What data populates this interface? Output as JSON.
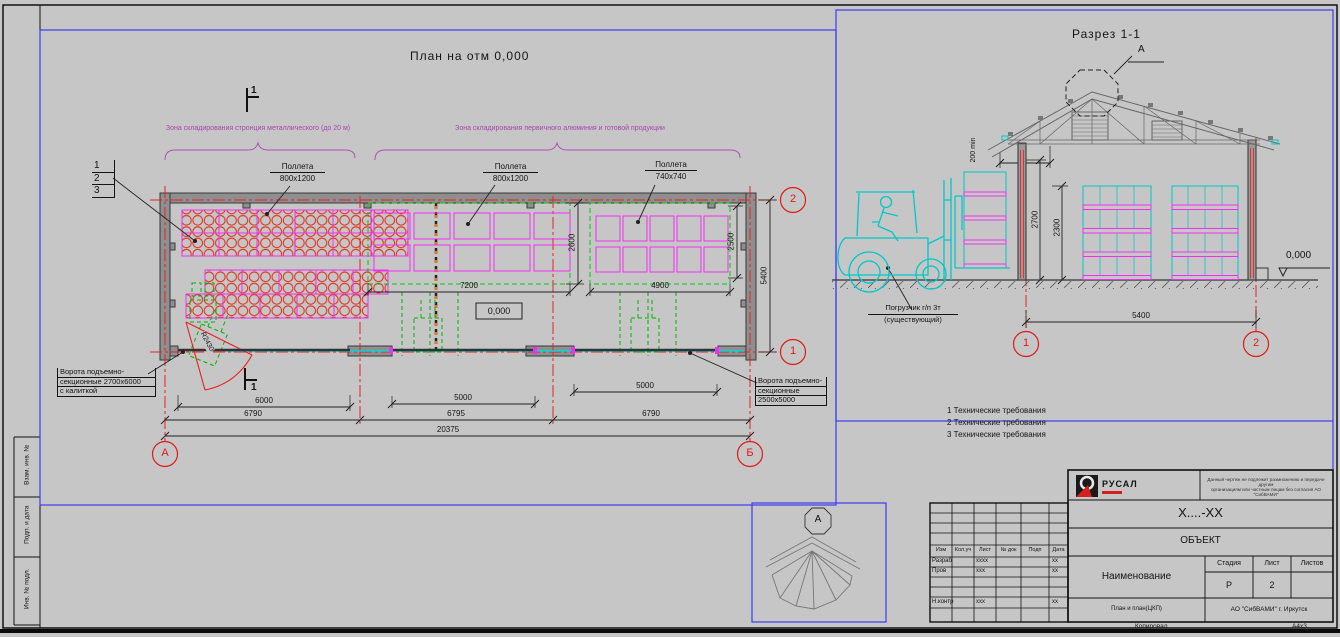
{
  "titles": {
    "plan": "План на отм 0,000",
    "section": "Разрез 1-1"
  },
  "zones": {
    "left": "Зона складирования стронция металлического (до 20 м)",
    "right": "Зона складирования первичного алюминия и готовой продукции"
  },
  "pallets": [
    {
      "l1": "Поллета",
      "l2": "800x1200"
    },
    {
      "l1": "Поллета",
      "l2": "800x1200"
    },
    {
      "l1": "Поллета",
      "l2": "740x740"
    }
  ],
  "stack_ref": [
    "1",
    "2",
    "3"
  ],
  "gate_left": {
    "l1": "Ворота подъемно-",
    "l2": "секционные 2700x6000",
    "l3": "с калиткой"
  },
  "gate_right": {
    "l1": "Ворота подъемно-",
    "l2": "секционные",
    "l3": "2500x5000"
  },
  "radius_label": "R2430",
  "dims": {
    "d7200": "7200",
    "d4900": "4900",
    "d2600": "2600",
    "d2500": "2500",
    "d5400": "5400",
    "d6000": "6000",
    "d5000a": "5000",
    "d5000b": "5000",
    "d6790a": "6790",
    "d6795": "6795",
    "d6790b": "6790",
    "d20375": "20375"
  },
  "elev_plan": "0,000",
  "markers": {
    "a": "А",
    "b": "Б",
    "m1": "1",
    "m2": "2"
  },
  "cuts": {
    "top": "1",
    "bottom": "1"
  },
  "section": {
    "dim200a": "200",
    "dim200b": "min",
    "d2700": "2700",
    "d2300": "2300",
    "d5400": "5400",
    "elev": "0,000",
    "m1": "1",
    "m2": "2",
    "fork1": "Погрузчик г/п 3т",
    "fork2": "(существующий)",
    "detail_ref": "А"
  },
  "detail": {
    "badge": "А"
  },
  "tech": [
    "1  Технические требования",
    "2  Технические требования",
    "3  Технические требования"
  ],
  "rev": {
    "headers": [
      "Изм",
      "Кол.уч",
      "Лист",
      "№ док",
      "Подп",
      "Дата"
    ],
    "rows": [
      [
        "Разраб",
        "xxxx",
        "xx"
      ],
      [
        "Пров",
        "xxx",
        "xx"
      ],
      [
        "Н.контр",
        "xxx",
        "xx"
      ]
    ]
  },
  "tb": {
    "logo": "РУСАЛ",
    "disclaimer1": "Данный чертеж не подлежит размножению и передаче другим",
    "disclaimer2": "организациям или частным лицам без согласия АО \"СибВАМИ\"",
    "code": "Х....-ХХ",
    "object": "ОБЪЕКТ",
    "name": "Наименование",
    "stage_h": "Стадия",
    "sheet_h": "Лист",
    "sheets_h": "Листов",
    "stage_v": "Р",
    "sheet_v": "2",
    "bottom_left": "План и план(ЦКП)",
    "company": "АО \"СибВАМИ\" г. Иркутск",
    "copied": "Копировал",
    "format": "А4х3"
  },
  "margins": [
    "Взам. инв. №",
    "Подп. и дата",
    "Инв. № подл."
  ]
}
